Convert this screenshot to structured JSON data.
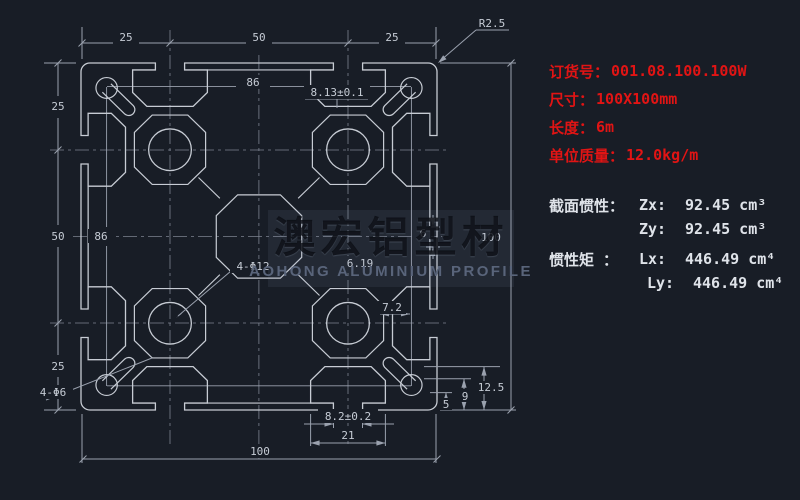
{
  "panel": {
    "order_label": "订货号：",
    "order_value": "001.08.100.100W",
    "size_label": "尺寸：",
    "size_value": "100X100mm",
    "length_label": "长度：",
    "length_value": "6m",
    "weight_label": "单位质量：",
    "weight_value": "12.0kg/m",
    "section_label": "截面惯性：",
    "zx_label": "Zx:",
    "zx_value": "92.45 cm³",
    "zy_label": "Zy:",
    "zy_value": "92.45 cm³",
    "inertia_label": "惯性矩 ：",
    "lx_label": "Lx:",
    "lx_value": "446.49 cm⁴",
    "ly_label": "Ly:",
    "ly_value": "446.49 cm⁴"
  },
  "watermark": {
    "cn": "澳宏铝型材",
    "en": "AOHONG ALUMINIUM PROFILE"
  },
  "dims": {
    "top": [
      "25",
      "50",
      "25"
    ],
    "left": [
      "25",
      "50",
      "25"
    ],
    "right_overall": "100",
    "bottom_overall": "100",
    "pitch_top": "86",
    "pitch_left": "86",
    "corner_radius": "R2.5",
    "top_slot_opening": "8.13±0.1",
    "bottom_slot_opening": "8.2±0.2",
    "slot_cavity_width": "21",
    "holes_large": "4-Φ12",
    "holes_small": "4-Φ6",
    "wall": "7.2",
    "d619": "6.19",
    "d6": "6",
    "d5": "5",
    "d9": "9",
    "d125": "12.5"
  },
  "colors": {
    "background": "#181d26",
    "profile_line": "#c7ccd4",
    "dimension_line": "#9aa1ae",
    "centerline": "#7c8390",
    "red_text": "#e11414",
    "white_text": "#dfe3e9"
  }
}
